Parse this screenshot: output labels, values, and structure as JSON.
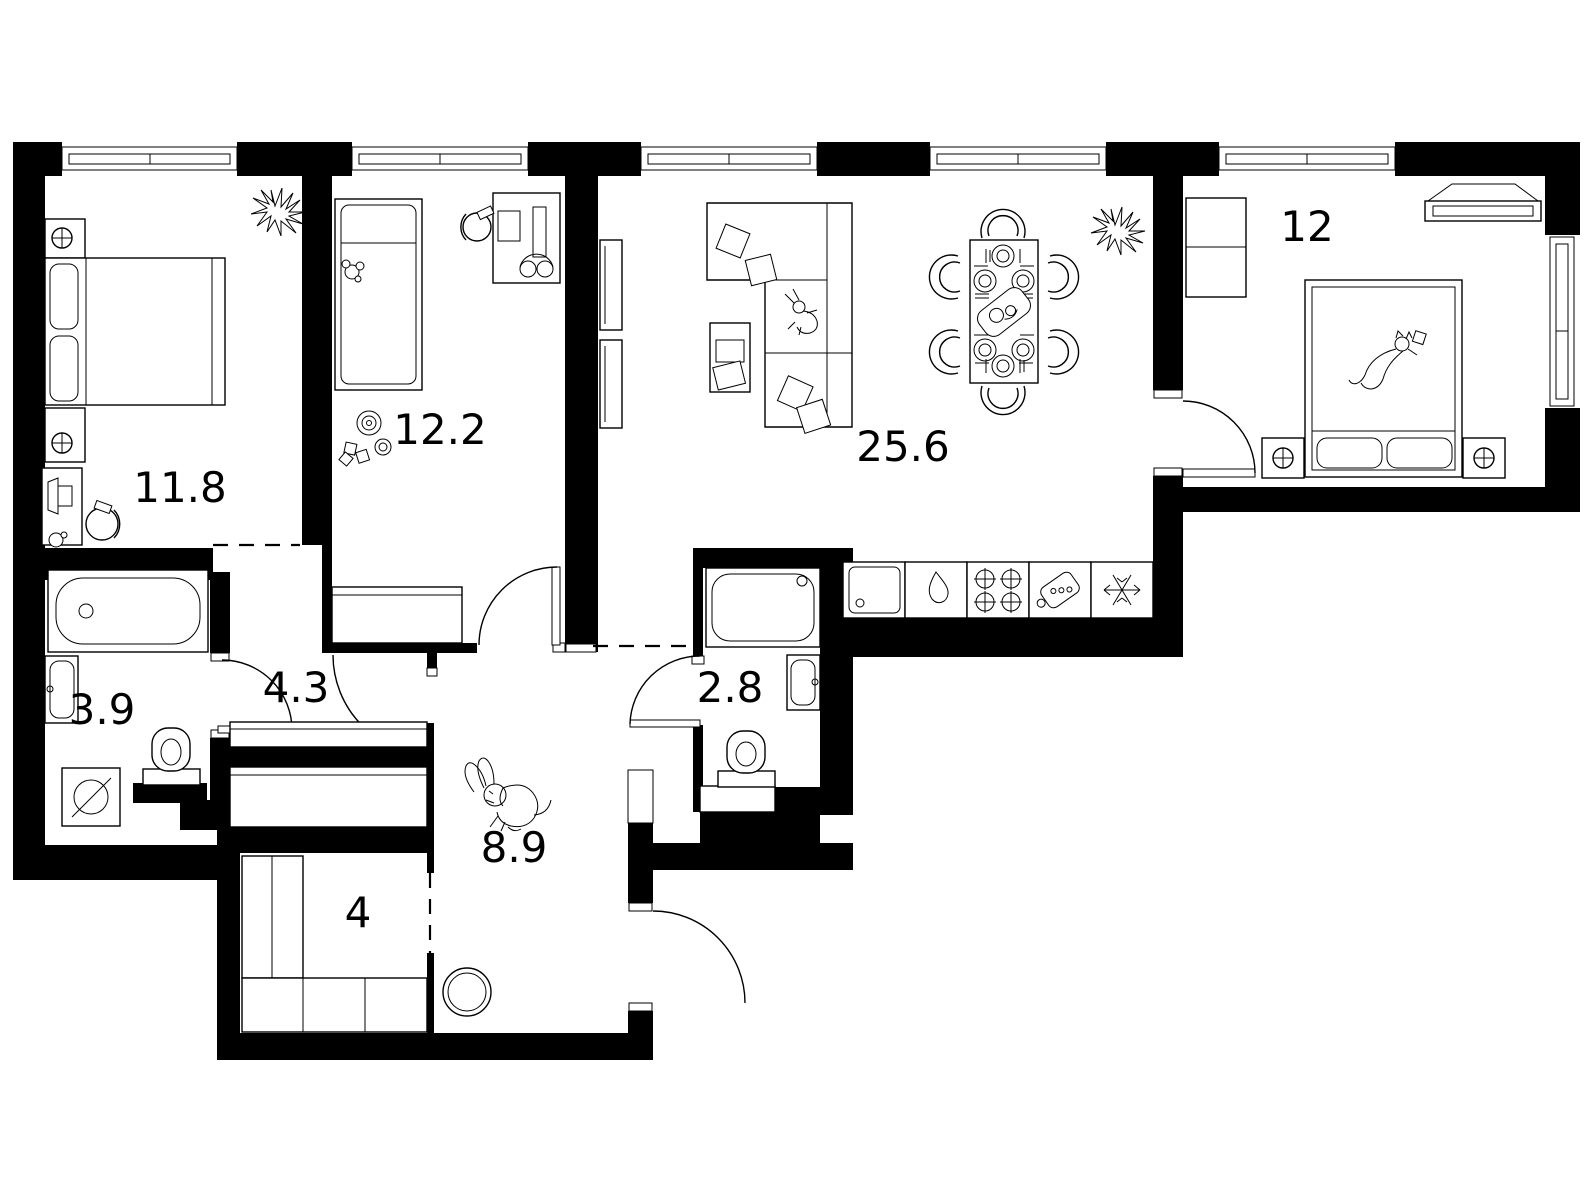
{
  "floor_plan": {
    "background_color": "#ffffff",
    "wall_color": "#000000",
    "line_color": "#000000",
    "rooms": [
      {
        "name": "bedroom-1",
        "area": "11.8"
      },
      {
        "name": "children-room",
        "area": "12.2"
      },
      {
        "name": "living-room-kitchen",
        "area": "25.6"
      },
      {
        "name": "bedroom-2",
        "area": "12"
      },
      {
        "name": "bathroom",
        "area": "3.9"
      },
      {
        "name": "hallway",
        "area": "4.3"
      },
      {
        "name": "shower-room",
        "area": "2.8"
      },
      {
        "name": "corridor",
        "area": "8.9"
      },
      {
        "name": "storage",
        "area": "4"
      }
    ]
  }
}
